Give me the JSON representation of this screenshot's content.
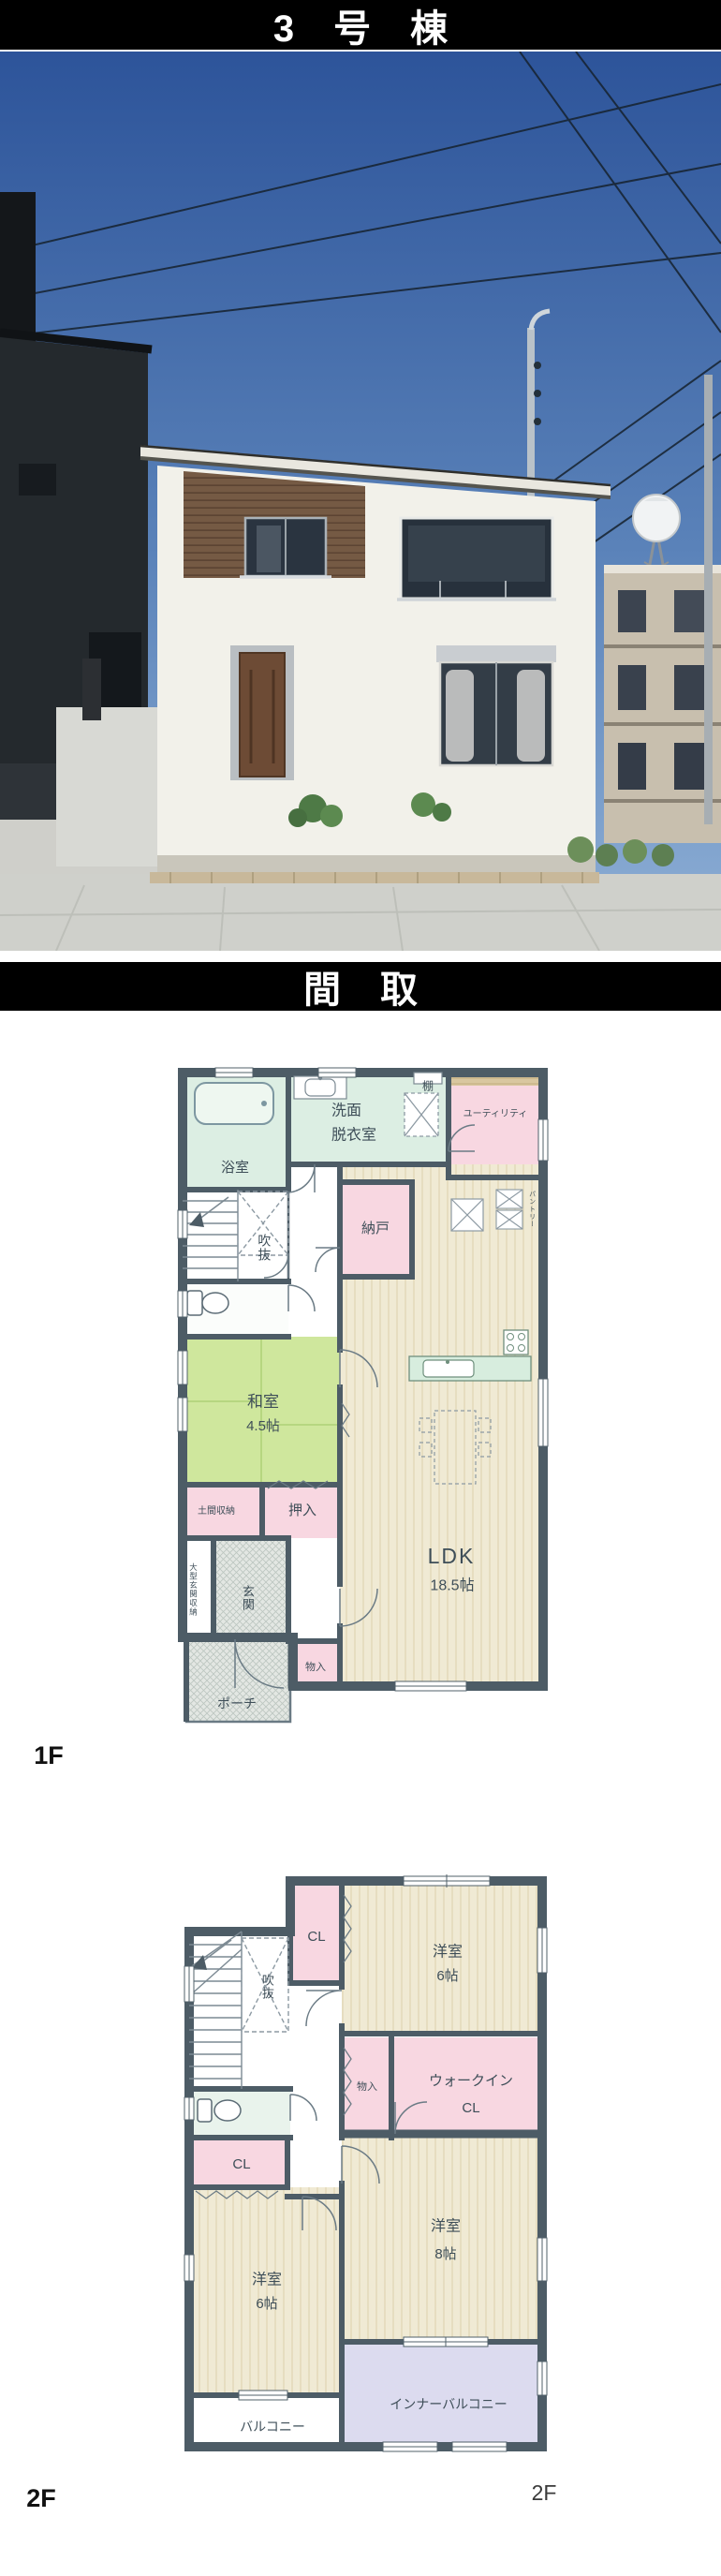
{
  "palette": {
    "bar_bg": "#000000",
    "bar_text": "#ffffff",
    "wall": "#4d5c66",
    "label": "#3e4e58",
    "pink": "#f8d7e1",
    "room_green": "#dceee3",
    "tatami_green": "#cfe79d",
    "wood_floor": "#f0ead4",
    "wood_strip": "#d9c7a0",
    "lavender": "#dcdbef",
    "hatch": "#e3e7e3",
    "sky_top": "#2d549a",
    "sky_bottom": "#8fb0d6"
  },
  "header": {
    "building_title": "3号棟"
  },
  "floorplan_section": {
    "title": "間取"
  },
  "floor1": {
    "floor_label": "1F",
    "rooms": {
      "bath": "浴室",
      "washroom_line1": "洗面",
      "washroom_line2": "脱衣室",
      "shelf": "棚",
      "utility": "ユーティリティ",
      "pantry": "パントリー",
      "storeroom": "納戸",
      "void": "吹抜",
      "japanese_room": "和室",
      "japanese_room_size": "4.5帖",
      "doma_storage": "土間収納",
      "oshiire": "押入",
      "entrance_storage": "大型玄関収納",
      "entrance": "玄関",
      "porch": "ポーチ",
      "storage": "物入",
      "ldk": "LDK",
      "ldk_size": "18.5帖"
    }
  },
  "floor2": {
    "floor_label": "2F",
    "floor_label_right": "2F",
    "rooms": {
      "closet_top": "CL",
      "bedroom6a": "洋室",
      "bedroom6a_size": "6帖",
      "void": "吹抜",
      "storage": "物入",
      "wic_line1": "ウォークイン",
      "wic_line2": "CL",
      "closet_left": "CL",
      "bedroom6b": "洋室",
      "bedroom6b_size": "6帖",
      "bedroom8": "洋室",
      "bedroom8_size": "8帖",
      "balcony": "バルコニー",
      "inner_balcony": "インナーバルコニー"
    }
  }
}
